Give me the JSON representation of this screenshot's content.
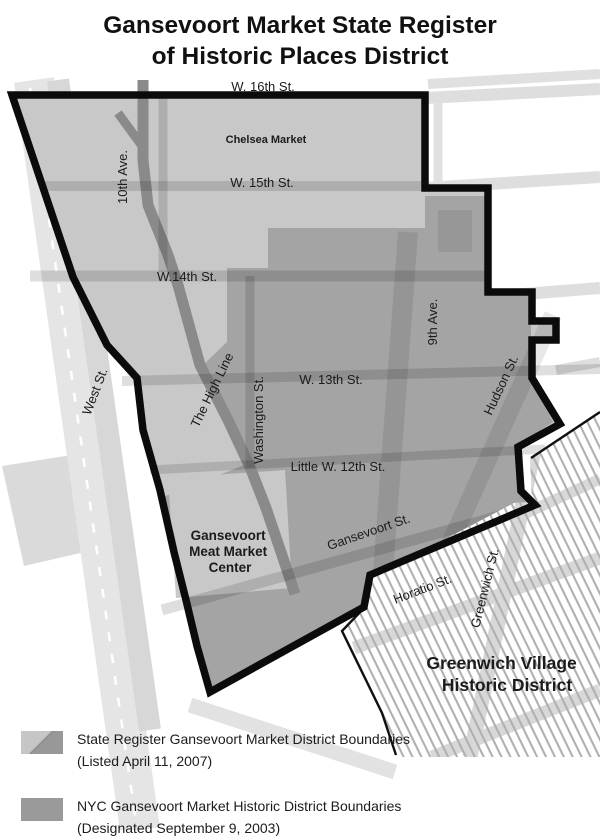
{
  "title": {
    "line1": "Gansevoort Market State Register",
    "line2": "of Historic Places District"
  },
  "map": {
    "streets": {
      "w16th": "W. 16th St.",
      "w15th": "W. 15th St.",
      "w14th": "W.14th St.",
      "w13th": "W. 13th St.",
      "little_w12th": "Little W. 12th St.",
      "gansevoort": "Gansevoort St.",
      "horatio": "Horatio St.",
      "tenth_ave": "10th Ave.",
      "ninth_ave": "9th Ave.",
      "washington": "Washington St.",
      "hudson": "Hudson St.",
      "greenwich": "Greenwich St.",
      "west": "West St.",
      "high_line": "The High Line"
    },
    "places": {
      "chelsea_market": "Chelsea Market",
      "meat_market_line1": "Gansevoort",
      "meat_market_line2": "Meat Market",
      "meat_market_line3": "Center",
      "gv_line1": "Greenwich Village",
      "gv_line2": "Historic District"
    }
  },
  "legend": {
    "items": [
      {
        "swatch": "split-diagonal-gray",
        "label_line1": "State Register Gansevoort Market District Boundaries",
        "label_line2": "(Listed April 11, 2007)"
      },
      {
        "swatch": "solid-gray",
        "label_line1": "NYC Gansevoort Market Historic District Boundaries",
        "label_line2": "(Designated September 9, 2003)"
      }
    ]
  },
  "colors": {
    "district_light": "#c8c8c8",
    "nyc_dark": "#a4a4a4",
    "boundary_black": "#0b0b0b",
    "high_line_gray": "#8a8a8a",
    "hatch_line": "#b0b0b0",
    "outside_street": "#dedede"
  }
}
